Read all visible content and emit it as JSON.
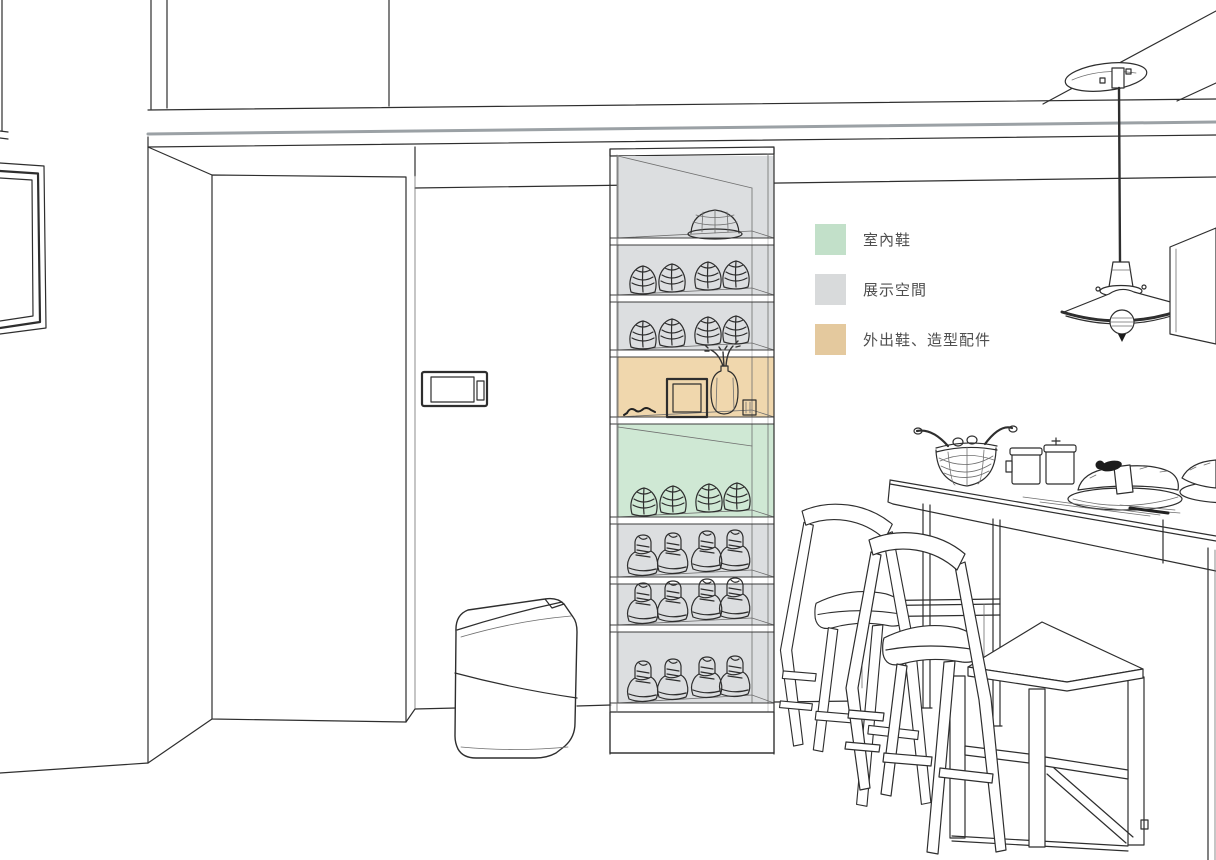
{
  "legend": {
    "items": [
      {
        "id": "indoor-shoes",
        "label": "室內鞋",
        "color": "#c2e0c9"
      },
      {
        "id": "display-space",
        "label": "展示空間",
        "color": "#d8dadb"
      },
      {
        "id": "outdoor-shoes-accessories",
        "label": "外出鞋、造型配件",
        "color": "#e4c99e"
      }
    ]
  },
  "cabinet": {
    "zone_fills": {
      "display": "#dcdee0",
      "indoor_shoes": "#cfe8d4",
      "outdoor_accessories": "#f0d7ad"
    }
  },
  "palette": {
    "beam_accent": "#9ba1a5"
  }
}
